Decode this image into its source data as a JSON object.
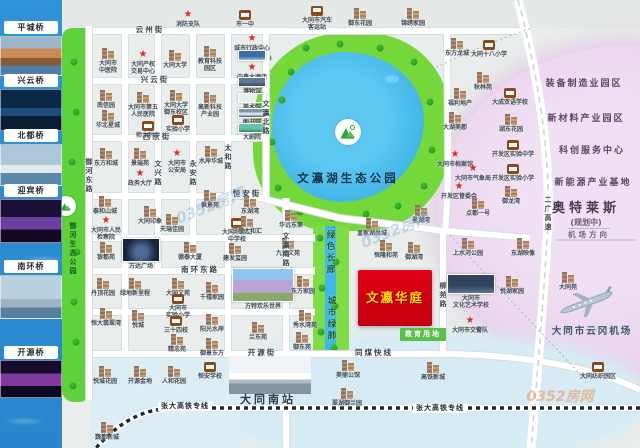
{
  "map_title": "文瀛华庭区位图",
  "property": {
    "name": "文瀛华庭",
    "land_tag": "教育用地"
  },
  "left_strip": {
    "items": [
      {
        "k": "label",
        "y": 21,
        "t": "平城桥"
      },
      {
        "k": "photo",
        "y": 36,
        "h": 40,
        "cls": "g1"
      },
      {
        "k": "label",
        "y": 74,
        "t": "兴云桥"
      },
      {
        "k": "photo",
        "y": 89,
        "h": 42,
        "cls": "g2"
      },
      {
        "k": "label",
        "y": 129,
        "t": "北都桥"
      },
      {
        "k": "photo",
        "y": 144,
        "h": 42,
        "cls": "g3"
      },
      {
        "k": "label",
        "y": 184,
        "t": "迎宾桥"
      },
      {
        "k": "photo",
        "y": 199,
        "h": 44,
        "cls": "g4"
      },
      {
        "k": "label",
        "y": 260,
        "t": "南环桥"
      },
      {
        "k": "photo",
        "y": 275,
        "h": 44,
        "cls": "g5"
      },
      {
        "k": "label",
        "y": 346,
        "t": "开源桥"
      },
      {
        "k": "photo",
        "y": 360,
        "h": 38,
        "cls": "g6"
      }
    ]
  },
  "parks": {
    "lake_park": "文瀛湖生态公园",
    "river_park": "御河生态公园",
    "corridor_north": "绿色长廊",
    "corridor_south": "城市绿肺"
  },
  "trees": [
    [
      268,
      58
    ],
    [
      282,
      100
    ],
    [
      272,
      142
    ],
    [
      278,
      188
    ],
    [
      300,
      212
    ],
    [
      332,
      218
    ],
    [
      366,
      214
    ],
    [
      398,
      206
    ],
    [
      424,
      186
    ],
    [
      432,
      150
    ],
    [
      430,
      102
    ],
    [
      414,
      62
    ],
    [
      380,
      48
    ],
    [
      340,
      44
    ],
    [
      306,
      48
    ],
    [
      291,
      72
    ],
    [
      320,
      238
    ],
    [
      336,
      262
    ],
    [
      322,
      288
    ],
    [
      335,
      306
    ],
    [
      321,
      332
    ],
    [
      334,
      348
    ],
    [
      74,
      62
    ],
    [
      76,
      112
    ],
    [
      72,
      162
    ],
    [
      77,
      252
    ],
    [
      74,
      302
    ],
    [
      76,
      342
    ],
    [
      73,
      386
    ]
  ],
  "markers": [
    {
      "t": "s",
      "x": 188,
      "y": 10,
      "l": "消防支队"
    },
    {
      "t": "sc",
      "x": 245,
      "y": 10,
      "l": "市一中"
    },
    {
      "t": "bus",
      "x": 317,
      "y": 6,
      "l": "大同市汽车\n客运站"
    },
    {
      "t": "b",
      "x": 360,
      "y": 8,
      "l": "御东花园"
    },
    {
      "t": "b",
      "x": 413,
      "y": 8,
      "l": "锦绣家园"
    },
    {
      "t": "b",
      "x": 108,
      "y": 48,
      "l": "大同市\n中医院"
    },
    {
      "t": "s",
      "x": 143,
      "y": 50,
      "l": "大同产权\n交易中心"
    },
    {
      "t": "b",
      "x": 175,
      "y": 50,
      "l": "大同大学"
    },
    {
      "t": "b",
      "x": 210,
      "y": 46,
      "l": "教育科技\n园区"
    },
    {
      "t": "s",
      "x": 252,
      "y": 34,
      "l": "城市行政中心"
    },
    {
      "t": "ph",
      "x": 252,
      "y": 50,
      "w": 28,
      "h": 11,
      "cls": "p-blue",
      "l": ""
    },
    {
      "t": "s",
      "x": 252,
      "y": 63,
      "l": "中鑫大酒店"
    },
    {
      "t": "phl",
      "x": 252,
      "y": 77,
      "w": 28,
      "h": 10,
      "cls": "p-museum",
      "l": "博物馆"
    },
    {
      "t": "phl",
      "x": 252,
      "y": 93,
      "w": 28,
      "h": 10,
      "cls": "p-art",
      "l": "美术馆"
    },
    {
      "t": "phl",
      "x": 252,
      "y": 108,
      "w": 28,
      "h": 10,
      "cls": "p-lib",
      "l": "图书馆"
    },
    {
      "t": "phl",
      "x": 252,
      "y": 123,
      "w": 28,
      "h": 10,
      "cls": "p-theater",
      "l": "大剧院"
    },
    {
      "t": "b",
      "x": 106,
      "y": 90,
      "l": "南信园"
    },
    {
      "t": "b",
      "x": 143,
      "y": 92,
      "l": "大同市第五\n人民医院"
    },
    {
      "t": "b",
      "x": 176,
      "y": 90,
      "l": "大同大学\n御东校区"
    },
    {
      "t": "b",
      "x": 210,
      "y": 92,
      "l": "高新科技\n产业园"
    },
    {
      "t": "b",
      "x": 108,
      "y": 110,
      "l": "华北星城"
    },
    {
      "t": "sc",
      "x": 148,
      "y": 121,
      "l": "师大附中"
    },
    {
      "t": "sc",
      "x": 178,
      "y": 115,
      "l": "实验小学"
    },
    {
      "t": "b",
      "x": 106,
      "y": 148,
      "l": "东方和城"
    },
    {
      "t": "b",
      "x": 140,
      "y": 148,
      "l": "景瑞苑"
    },
    {
      "t": "s",
      "x": 177,
      "y": 149,
      "l": "大同市\n公安局"
    },
    {
      "t": "b",
      "x": 211,
      "y": 146,
      "l": "水岸华城"
    },
    {
      "t": "s",
      "x": 140,
      "y": 169,
      "l": "政务大厅"
    },
    {
      "t": "b",
      "x": 105,
      "y": 196,
      "l": "泰和山城"
    },
    {
      "t": "s",
      "x": 106,
      "y": 216,
      "l": "大同市人民\n检察院"
    },
    {
      "t": "b",
      "x": 150,
      "y": 206,
      "l": "大同印象"
    },
    {
      "t": "b",
      "x": 172,
      "y": 214,
      "l": "天瑞佳园"
    },
    {
      "t": "b",
      "x": 210,
      "y": 190,
      "l": "枫景苑"
    },
    {
      "t": "sc",
      "x": 237,
      "y": 218,
      "l": "大同市第二\n中学校"
    },
    {
      "t": "b",
      "x": 250,
      "y": 196,
      "l": "东湖湾"
    },
    {
      "t": "b",
      "x": 247,
      "y": 216,
      "l": "三盛太和汇"
    },
    {
      "t": "b",
      "x": 291,
      "y": 210,
      "l": "华远东第"
    },
    {
      "t": "b",
      "x": 106,
      "y": 242,
      "l": "银都苑"
    },
    {
      "t": "phl",
      "x": 141,
      "y": 238,
      "w": 38,
      "h": 24,
      "cls": "p-wanda",
      "l": "万达广场"
    },
    {
      "t": "b",
      "x": 190,
      "y": 242,
      "l": "德泰大厦"
    },
    {
      "t": "b",
      "x": 235,
      "y": 243,
      "l": "建发玺园"
    },
    {
      "t": "b",
      "x": 288,
      "y": 238,
      "l": "九如文苑"
    },
    {
      "t": "b",
      "x": 372,
      "y": 218,
      "l": "皇家湖尚城"
    },
    {
      "t": "b",
      "x": 386,
      "y": 240,
      "l": "恒隆和苑"
    },
    {
      "t": "b",
      "x": 414,
      "y": 242,
      "l": "御湖湾"
    },
    {
      "t": "b",
      "x": 421,
      "y": 205,
      "l": "星湖湾"
    },
    {
      "t": "b",
      "x": 457,
      "y": 38,
      "l": "东方龙城"
    },
    {
      "t": "sc",
      "x": 489,
      "y": 40,
      "l": "大同十八小学"
    },
    {
      "t": "b",
      "x": 483,
      "y": 72,
      "l": "秋林苑"
    },
    {
      "t": "b",
      "x": 460,
      "y": 88,
      "l": "福利地产"
    },
    {
      "t": "sc",
      "x": 510,
      "y": 88,
      "l": "大成双语学校"
    },
    {
      "t": "b",
      "x": 455,
      "y": 112,
      "l": "大湖美郡"
    },
    {
      "t": "b",
      "x": 511,
      "y": 114,
      "l": "湖东花园"
    },
    {
      "t": "sc",
      "x": 513,
      "y": 140,
      "l": "开发区实验中学"
    },
    {
      "t": "s",
      "x": 455,
      "y": 150,
      "l": "大同市档案馆"
    },
    {
      "t": "sc",
      "x": 513,
      "y": 164,
      "l": "开发区实验小学"
    },
    {
      "t": "s",
      "x": 473,
      "y": 164,
      "l": "大同市气象局"
    },
    {
      "t": "s",
      "x": 459,
      "y": 182,
      "l": "开发区管委会"
    },
    {
      "t": "b",
      "x": 511,
      "y": 186,
      "l": "御龙湾"
    },
    {
      "t": "b",
      "x": 478,
      "y": 198,
      "l": "点都一号"
    },
    {
      "t": "b",
      "x": 468,
      "y": 238,
      "l": "上水河公园"
    },
    {
      "t": "b",
      "x": 523,
      "y": 238,
      "l": "东湖映像"
    },
    {
      "t": "b",
      "x": 512,
      "y": 276,
      "l": "悦湖家园"
    },
    {
      "t": "b",
      "x": 568,
      "y": 272,
      "l": "大同苑"
    },
    {
      "t": "phl",
      "x": 471,
      "y": 274,
      "w": 48,
      "h": 20,
      "cls": "p-school",
      "l": "大同市\n文化艺术学校"
    },
    {
      "t": "s",
      "x": 470,
      "y": 316,
      "l": "大同市交警队"
    },
    {
      "t": "b",
      "x": 103,
      "y": 278,
      "l": "丹顶花园"
    },
    {
      "t": "b",
      "x": 135,
      "y": 278,
      "l": "绿地新里程"
    },
    {
      "t": "b",
      "x": 178,
      "y": 278,
      "l": "大同文苑"
    },
    {
      "t": "sc",
      "x": 178,
      "y": 294,
      "l": "大同市\n实验小学"
    },
    {
      "t": "b",
      "x": 106,
      "y": 308,
      "l": "恒大翡翠湾"
    },
    {
      "t": "b",
      "x": 138,
      "y": 310,
      "l": "悦城"
    },
    {
      "t": "sc",
      "x": 176,
      "y": 316,
      "l": "三十四校"
    },
    {
      "t": "b",
      "x": 177,
      "y": 334,
      "l": "精忠苑"
    },
    {
      "t": "b",
      "x": 212,
      "y": 282,
      "l": "千禧家园"
    },
    {
      "t": "b",
      "x": 212,
      "y": 314,
      "l": "阳光水岸"
    },
    {
      "t": "b",
      "x": 212,
      "y": 338,
      "l": "御景东方"
    },
    {
      "t": "phl",
      "x": 263,
      "y": 268,
      "w": 62,
      "h": 34,
      "cls": "p-castle",
      "l": "方特欢乐世界"
    },
    {
      "t": "b",
      "x": 258,
      "y": 322,
      "l": "兰东苑"
    },
    {
      "t": "b",
      "x": 303,
      "y": 276,
      "l": "东方家园"
    },
    {
      "t": "b",
      "x": 305,
      "y": 310,
      "l": "秀水湾苑"
    },
    {
      "t": "b",
      "x": 302,
      "y": 332,
      "l": "御东苑"
    },
    {
      "t": "b",
      "x": 105,
      "y": 366,
      "l": "悦城花园"
    },
    {
      "t": "b",
      "x": 140,
      "y": 366,
      "l": "开源金地"
    },
    {
      "t": "b",
      "x": 174,
      "y": 366,
      "l": "人和花园"
    },
    {
      "t": "sc",
      "x": 210,
      "y": 362,
      "l": "恒安学校"
    },
    {
      "t": "ph",
      "x": 270,
      "y": 356,
      "w": 82,
      "h": 38,
      "cls": "p-train",
      "l": ""
    },
    {
      "t": "b",
      "x": 348,
      "y": 360,
      "l": "美丽公馆"
    },
    {
      "t": "b",
      "x": 347,
      "y": 388,
      "l": "翠湖御兰园"
    },
    {
      "t": "b",
      "x": 433,
      "y": 362,
      "l": "高铁新城"
    },
    {
      "t": "b",
      "x": 107,
      "y": 422,
      "l": "魏都新城"
    },
    {
      "t": "sc",
      "x": 598,
      "y": 362,
      "l": "大同纺织园区"
    },
    {
      "t": "rl",
      "x": 150,
      "y": 26,
      "l": "云州街"
    },
    {
      "t": "rl",
      "x": 155,
      "y": 76,
      "l": "兴云街"
    },
    {
      "t": "rl",
      "x": 157,
      "y": 133,
      "l": "西京街"
    },
    {
      "t": "rl",
      "x": 247,
      "y": 190,
      "l": "恒安街"
    },
    {
      "t": "rl",
      "x": 200,
      "y": 266,
      "l": "南环东路"
    },
    {
      "t": "rl",
      "x": 262,
      "y": 349,
      "l": "开源街"
    },
    {
      "t": "rl",
      "x": 374,
      "y": 349,
      "l": "同煤快线"
    },
    {
      "t": "rlv",
      "x": 89,
      "y": 158,
      "l": "御河东路"
    },
    {
      "t": "rlv",
      "x": 158,
      "y": 160,
      "l": "文兴路"
    },
    {
      "t": "rlv",
      "x": 193,
      "y": 160,
      "l": "永安路"
    },
    {
      "t": "rlv",
      "x": 228,
      "y": 144,
      "l": "太和路"
    },
    {
      "t": "rlv",
      "x": 266,
      "y": 100,
      "l": "文瀛北路"
    },
    {
      "t": "rlv",
      "x": 286,
      "y": 232,
      "l": "文瀛南路"
    },
    {
      "t": "rlv",
      "x": 443,
      "y": 282,
      "l": "柳苑路"
    },
    {
      "t": "rlv",
      "x": 548,
      "y": 196,
      "l": "二广高速"
    },
    {
      "t": "rwl",
      "x": 185,
      "y": 402,
      "l": "张大高铁专线"
    },
    {
      "t": "rwl",
      "x": 440,
      "y": 404,
      "l": "张大高铁专线"
    },
    {
      "t": "z",
      "x": 584,
      "y": 79,
      "l": "装备制造业园区"
    },
    {
      "t": "z",
      "x": 586,
      "y": 114,
      "l": "新材料产业园区"
    },
    {
      "t": "z",
      "x": 592,
      "y": 146,
      "l": "科创服务中心"
    },
    {
      "t": "z",
      "x": 593,
      "y": 178,
      "l": "新能源产业基地"
    },
    {
      "t": "zb",
      "x": 586,
      "y": 202,
      "l": "奥特莱斯"
    },
    {
      "t": "z2",
      "x": 586,
      "y": 218,
      "l": "(规划中)"
    },
    {
      "t": "dir",
      "x": 589,
      "y": 228,
      "l": "机场方向"
    },
    {
      "t": "airport",
      "x": 592,
      "y": 326,
      "l": "大同市云冈机场"
    },
    {
      "t": "station",
      "x": 268,
      "y": 394,
      "l": "大同南站"
    },
    {
      "t": "parkname",
      "x": 348,
      "y": 172,
      "l": "文瀛湖生态公园"
    },
    {
      "t": "vgreen",
      "x": 73,
      "y": 222,
      "l": "御河生态公园"
    },
    {
      "t": "vg2",
      "x": 330,
      "y": 230,
      "l": "绿色长廊"
    },
    {
      "t": "vg2",
      "x": 331,
      "y": 296,
      "l": "城市绿肺"
    },
    {
      "t": "wm1",
      "x": 210,
      "y": 198,
      "l": "0352房网"
    },
    {
      "t": "wm1",
      "x": 395,
      "y": 222,
      "l": "0352房网"
    },
    {
      "t": "wm2",
      "x": 560,
      "y": 390,
      "l": "0352房网"
    }
  ]
}
